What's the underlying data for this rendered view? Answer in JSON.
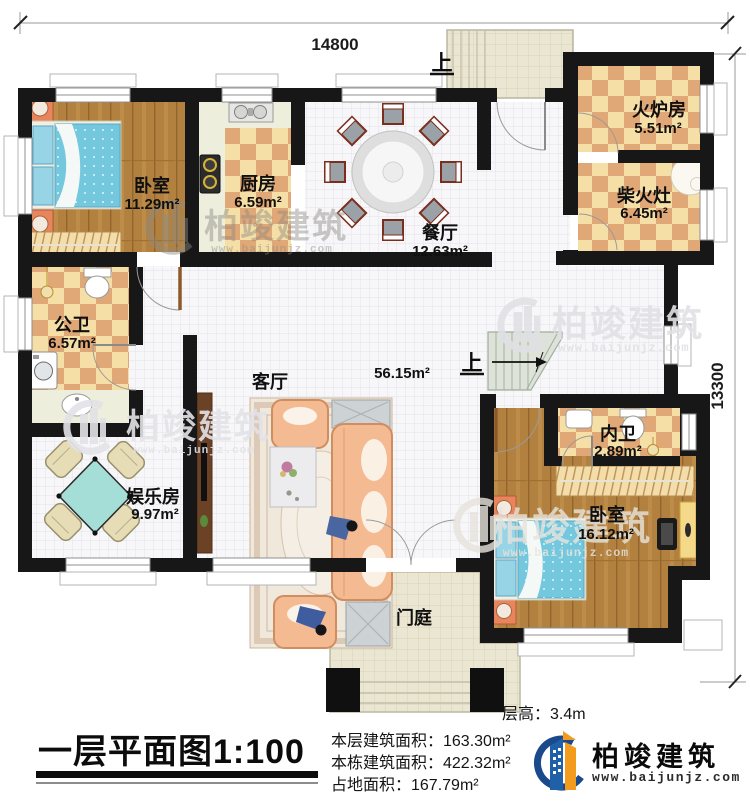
{
  "plan": {
    "dimensions": {
      "width_mm": "14800",
      "height_mm": "13300"
    },
    "rooms": {
      "bedroom_nw": {
        "name": "卧室",
        "area": "11.29m²"
      },
      "kitchen": {
        "name": "厨房",
        "area": "6.59m²"
      },
      "dining": {
        "name": "餐厅",
        "area": "12.63m²"
      },
      "furnace": {
        "name": "火炉房",
        "area": "5.51m²"
      },
      "wood_stove": {
        "name": "柴火灶",
        "area": "6.45m²"
      },
      "public_bath": {
        "name": "公卫",
        "area": "6.57m²"
      },
      "living": {
        "name": "客厅",
        "area": "56.15m²"
      },
      "game_room": {
        "name": "娱乐房",
        "area": "9.97m²"
      },
      "ensuite_bath": {
        "name": "内卫",
        "area": "2.89m²"
      },
      "bedroom_se": {
        "name": "卧室",
        "area": "16.12m²"
      },
      "porch": {
        "name": "门庭"
      }
    },
    "stair_up_label": "上"
  },
  "watermark": {
    "brand": "柏竣建筑",
    "url": "www.baijunjz.com"
  },
  "footer": {
    "plan_title": "一层平面图1:100",
    "floor_height": "层高：3.4m",
    "stats": [
      "本层建筑面积：163.30m²",
      "本栋建筑面积：422.32m²",
      "占地面积：167.79m²"
    ],
    "logo": {
      "brand": "柏竣建筑",
      "url": "www.baijunjz.com"
    }
  }
}
